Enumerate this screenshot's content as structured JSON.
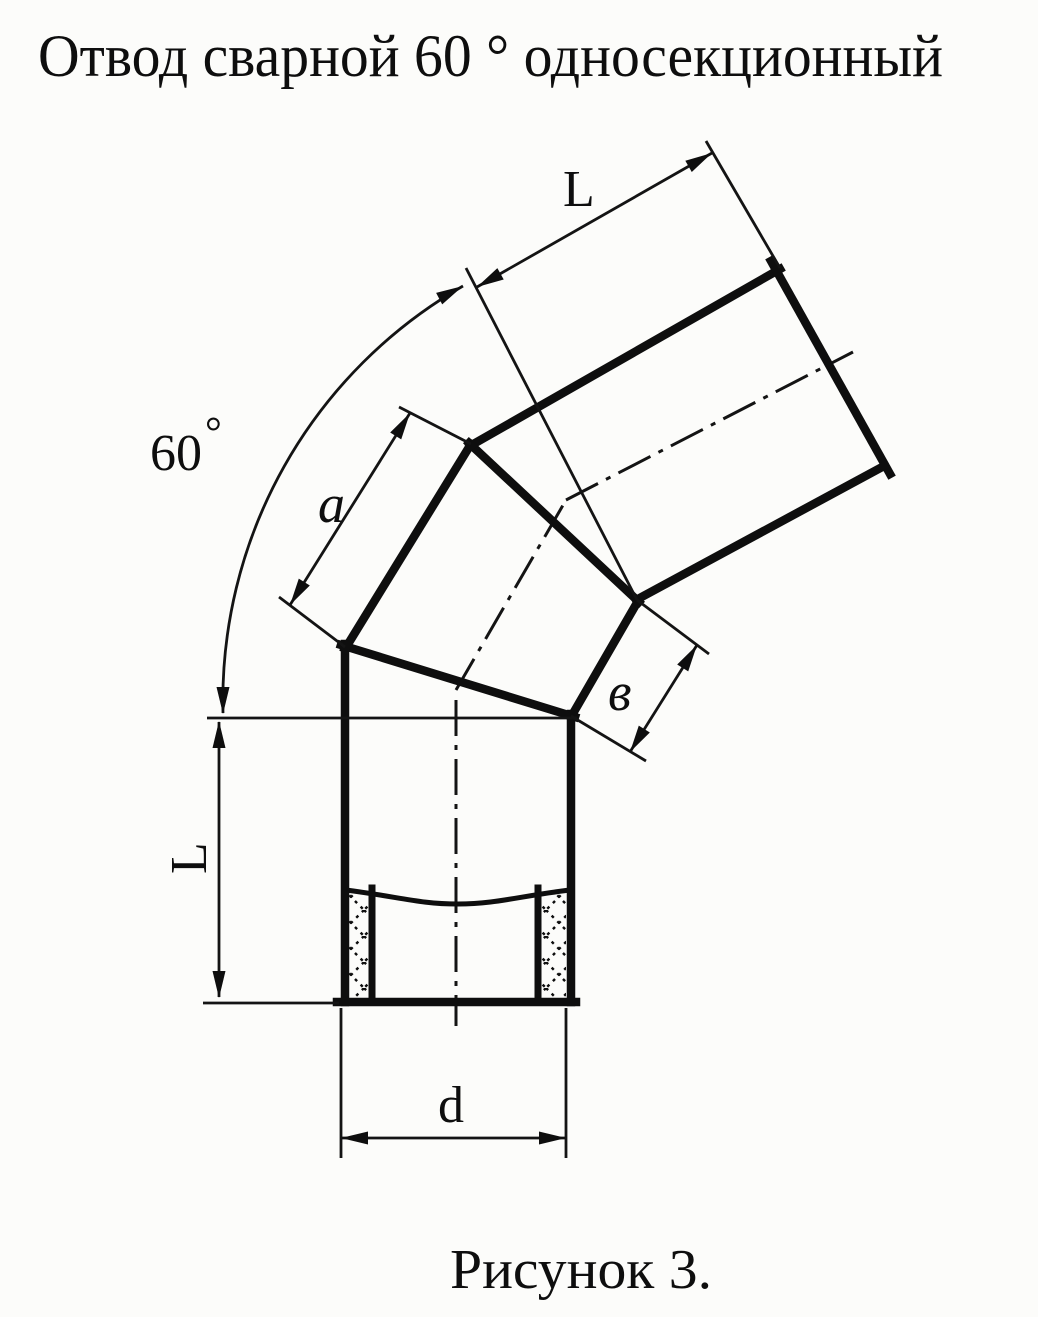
{
  "title": "Отвод сварной 60 ° односекционный",
  "caption": "Рисунок 3.",
  "labels": {
    "upper_pipe_length": "L",
    "angle_value": "60",
    "angle_degree_mark": "°",
    "middle_section_outer_edge": "a",
    "middle_section_inner_edge": "в",
    "lower_pipe_length": "L",
    "pipe_diameter": "d"
  },
  "drawing": {
    "type": "technical-drawing",
    "subject": "welded 60-degree single-section pipe elbow",
    "bend_angle_deg": 60,
    "sections": [
      "lower vertical pipe with socket insert",
      "middle welded section",
      "upper inclined pipe"
    ],
    "dimensioned_features": {
      "L": "straight pipe segment length (shown on both ends)",
      "a": "outer edge length of middle section",
      "в": "inner edge length of middle section",
      "d": "pipe diameter",
      "60°": "total bend angle arc"
    },
    "ink_color": "#0e0e0e",
    "paper_color": "#fcfcfa"
  }
}
